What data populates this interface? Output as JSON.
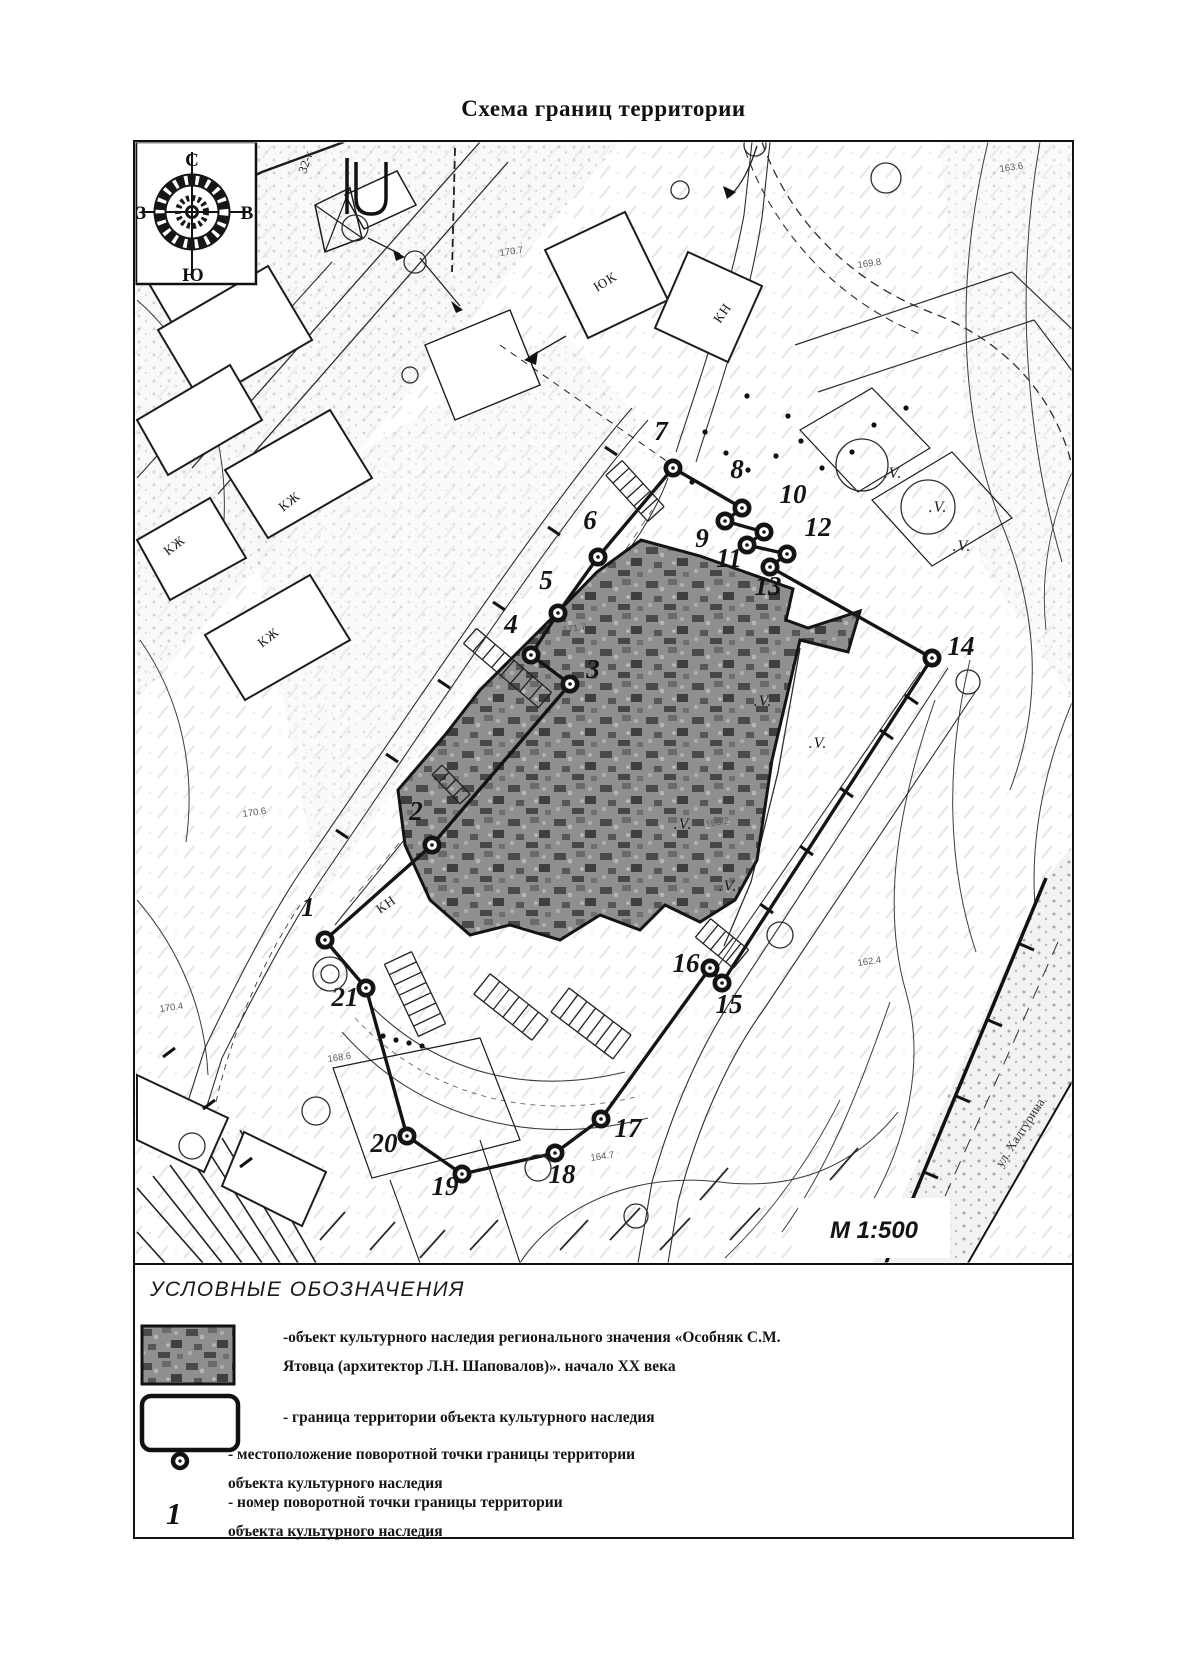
{
  "title": "Схема границ территории",
  "compass": {
    "n": "С",
    "s": "Ю",
    "e": "В",
    "w": "З"
  },
  "scale_label": "М 1:500",
  "street_label": "ул. Халтурина",
  "veg_symbol": ".V.",
  "plot_label": "32-к",
  "boundary_points": [
    {
      "n": "1",
      "mx": 325,
      "my": 940,
      "lx": 308,
      "ly": 916
    },
    {
      "n": "2",
      "mx": 432,
      "my": 845,
      "lx": 416,
      "ly": 820
    },
    {
      "n": "3",
      "mx": 570,
      "my": 684,
      "lx": 593,
      "ly": 678
    },
    {
      "n": "4",
      "mx": 531,
      "my": 655,
      "lx": 511,
      "ly": 633
    },
    {
      "n": "5",
      "mx": 558,
      "my": 613,
      "lx": 546,
      "ly": 589
    },
    {
      "n": "6",
      "mx": 598,
      "my": 557,
      "lx": 590,
      "ly": 529
    },
    {
      "n": "7",
      "mx": 673,
      "my": 468,
      "lx": 661,
      "ly": 440
    },
    {
      "n": "8",
      "mx": 742,
      "my": 508,
      "lx": 737,
      "ly": 478
    },
    {
      "n": "9",
      "mx": 725,
      "my": 521,
      "lx": 702,
      "ly": 547
    },
    {
      "n": "10",
      "mx": 764,
      "my": 532,
      "lx": 793,
      "ly": 503
    },
    {
      "n": "11",
      "mx": 747,
      "my": 545,
      "lx": 729,
      "ly": 567
    },
    {
      "n": "12",
      "mx": 787,
      "my": 554,
      "lx": 818,
      "ly": 536
    },
    {
      "n": "13",
      "mx": 770,
      "my": 567,
      "lx": 768,
      "ly": 595
    },
    {
      "n": "14",
      "mx": 932,
      "my": 658,
      "lx": 961,
      "ly": 655
    },
    {
      "n": "15",
      "mx": 722,
      "my": 983,
      "lx": 729,
      "ly": 1013
    },
    {
      "n": "16",
      "mx": 710,
      "my": 968,
      "lx": 686,
      "ly": 972
    },
    {
      "n": "17",
      "mx": 601,
      "my": 1119,
      "lx": 628,
      "ly": 1137
    },
    {
      "n": "18",
      "mx": 555,
      "my": 1153,
      "lx": 562,
      "ly": 1183
    },
    {
      "n": "19",
      "mx": 462,
      "my": 1174,
      "lx": 445,
      "ly": 1195
    },
    {
      "n": "20",
      "mx": 407,
      "my": 1136,
      "lx": 384,
      "ly": 1152
    },
    {
      "n": "21",
      "mx": 366,
      "my": 988,
      "lx": 345,
      "ly": 1006
    }
  ],
  "building_labels": [
    {
      "t": "КЖ",
      "x": 283,
      "y": 512,
      "r": -38
    },
    {
      "t": "КЖ",
      "x": 168,
      "y": 556,
      "r": -38
    },
    {
      "t": "КЖ",
      "x": 262,
      "y": 648,
      "r": -38
    },
    {
      "t": "ЮК",
      "x": 597,
      "y": 292,
      "r": -32
    },
    {
      "t": "КН",
      "x": 720,
      "y": 324,
      "r": -55
    },
    {
      "t": "КН",
      "x": 380,
      "y": 914,
      "r": -35
    }
  ],
  "elevation_marks": [
    {
      "t": "170.7",
      "x": 500,
      "y": 256
    },
    {
      "t": "163.6",
      "x": 1000,
      "y": 172
    },
    {
      "t": "169.8",
      "x": 858,
      "y": 268
    },
    {
      "t": "170.6",
      "x": 243,
      "y": 817
    },
    {
      "t": "168.6",
      "x": 328,
      "y": 1062
    },
    {
      "t": "164.7",
      "x": 591,
      "y": 1161
    },
    {
      "t": "162.4",
      "x": 858,
      "y": 966
    },
    {
      "t": "166.2",
      "x": 706,
      "y": 827
    },
    {
      "t": "171.7",
      "x": 563,
      "y": 633
    },
    {
      "t": "170.4",
      "x": 160,
      "y": 1012
    }
  ],
  "veg_marks": [
    {
      "x": 893,
      "y": 478
    },
    {
      "x": 938,
      "y": 512
    },
    {
      "x": 763,
      "y": 706
    },
    {
      "x": 818,
      "y": 748
    },
    {
      "x": 683,
      "y": 829
    },
    {
      "x": 728,
      "y": 891
    },
    {
      "x": 962,
      "y": 551
    }
  ],
  "legend": {
    "header": "УСЛОВНЫЕ ОБОЗНАЧЕНИЯ",
    "items": [
      {
        "id": "heritage-object",
        "text_lines": [
          "-объект культурного наследия регионального значения «Особняк С.М.",
          "Ятовца (архитектор Л.Н. Шаповалов)». начало XX века"
        ]
      },
      {
        "id": "territory-border",
        "text_lines": [
          "- граница территории объекта культурного наследия"
        ]
      },
      {
        "id": "turning-point-location",
        "text_lines": [
          "- местоположение поворотной точки границы территории",
          "объекта культурного наследия"
        ]
      },
      {
        "id": "turning-point-number",
        "symbol_glyph": "1",
        "text_lines": [
          "- номер поворотной точки границы территории",
          "объекта культурного наследия"
        ]
      }
    ]
  }
}
